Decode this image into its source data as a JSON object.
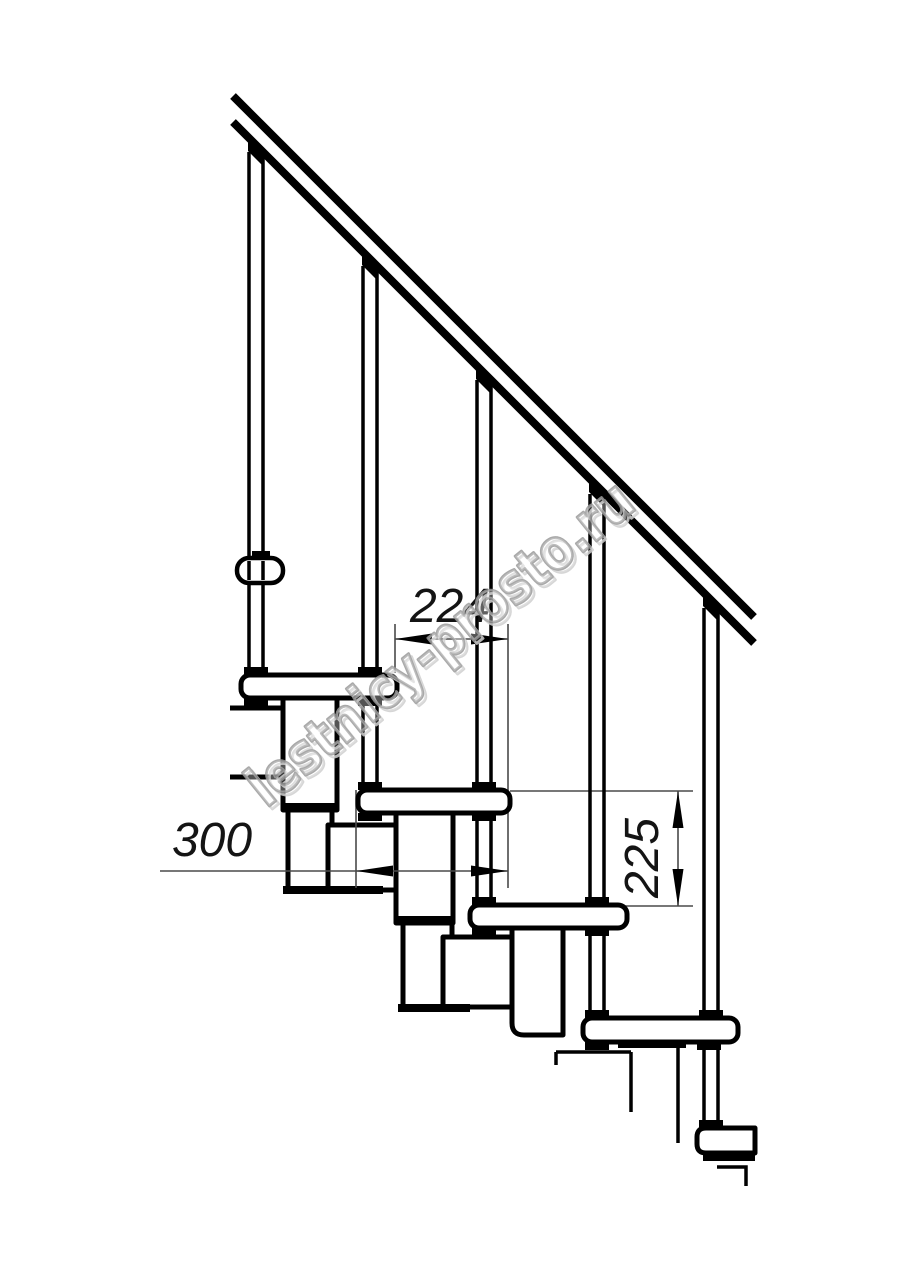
{
  "drawing": {
    "title_hidden": "",
    "watermark": {
      "text": "lestnicy-prosto.ru",
      "color": "#9b9b9b"
    },
    "dimensions": {
      "step_run": {
        "label": "224"
      },
      "tread_depth": {
        "label": "300"
      },
      "riser_height": {
        "label": "225"
      }
    },
    "colors": {
      "line": "#000000",
      "dimension_line": "#4a4a4a",
      "watermark": "#9b9b9b",
      "background": "#ffffff"
    }
  }
}
